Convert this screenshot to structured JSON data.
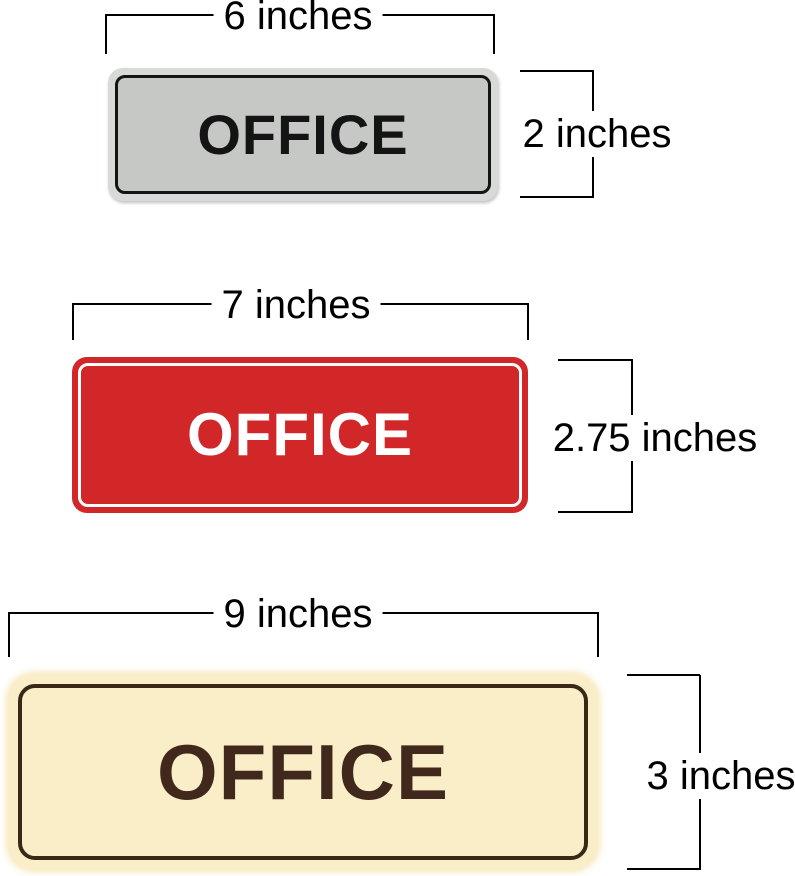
{
  "annotation": {
    "color": "#000000"
  },
  "signs": [
    {
      "name": "office-sign-6x2",
      "label": "OFFICE",
      "width_label": "6 inches",
      "height_label": "2 inches",
      "rim_color": "#d8dad7",
      "face_color": "#c6c8c5",
      "border_color": "#141414",
      "text_color": "#141414"
    },
    {
      "name": "office-sign-7x2.75",
      "label": "OFFICE",
      "width_label": "7 inches",
      "height_label": "2.75 inches",
      "face_color": "#d22729",
      "border_color": "#ffffff",
      "text_color": "#ffffff"
    },
    {
      "name": "office-sign-9x3",
      "label": "OFFICE",
      "width_label": "9 inches",
      "height_label": "3 inches",
      "face_color": "#faeec9",
      "border_color": "#3a2817",
      "text_color": "#40291c"
    }
  ]
}
